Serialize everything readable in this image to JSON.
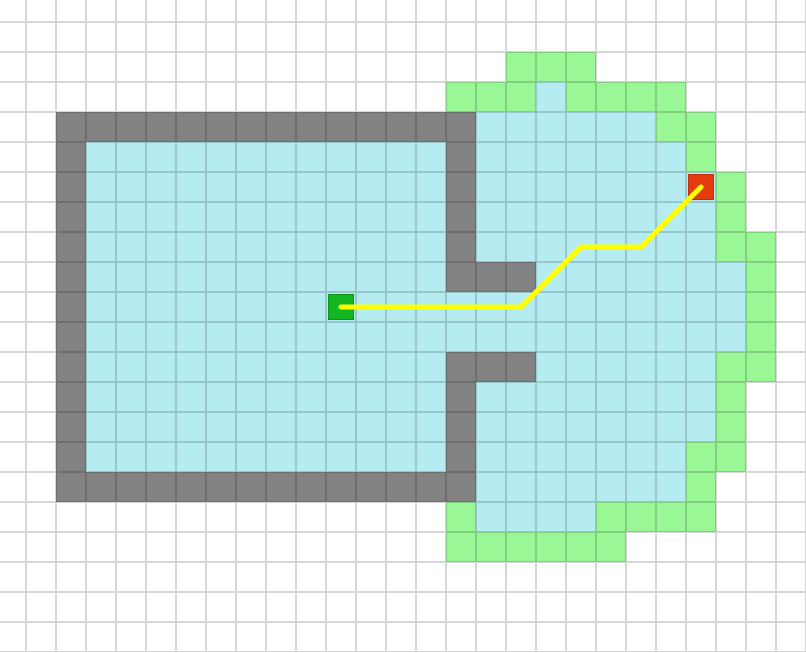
{
  "grid_map": {
    "cols": 27,
    "rows": 22,
    "cell_size": 30,
    "offset_x": -4,
    "offset_y": -8,
    "legend": {
      ".": "unexplored",
      "#": "wall",
      "o": "explored-free",
      "f": "frontier",
      "S": "start",
      "G": "goal"
    },
    "rows_map": [
      "...........................",
      "...........................",
      ".................fff.......",
      "...............fffoffff....",
      "..##############ooooooff...",
      "..#oooooooooooo#ooooooof...",
      "..#oooooooooooo#oooooooGf..",
      "..#oooooooooooo#oooooooof..",
      "..#oooooooooooo#ooooooooff.",
      "..#oooooooooooo###ooooooof.",
      "..#ooooooooSooooooooooooof.",
      "..#oooooooooooooooooooooof.",
      "..#oooooooooooo###ooooooff.",
      "..#oooooooooooo#oooooooof..",
      "..#oooooooooooo#oooooooof..",
      "..#oooooooooooo#oooooooff..",
      "..##############ooooooof...",
      "...............fooooffff...",
      "...............ffffff......",
      "...........................",
      "...........................",
      "..........................."
    ],
    "start": {
      "col": 11,
      "row": 10
    },
    "goal": {
      "col": 23,
      "row": 6
    },
    "path_cells": [
      [
        11,
        10
      ],
      [
        17,
        10
      ],
      [
        19,
        8
      ],
      [
        21,
        8
      ],
      [
        23,
        6
      ]
    ],
    "path_width": 5,
    "colors": {
      "unexplored": "#ffffff",
      "wall": "#828282",
      "explored": "#b4ecf1",
      "frontier": "#99f795",
      "start_fill": "#12b722",
      "start_border": "#0b9617",
      "goal_fill": "#e33b0d",
      "goal_border": "#bf2f07",
      "path": "#ffff00"
    }
  }
}
